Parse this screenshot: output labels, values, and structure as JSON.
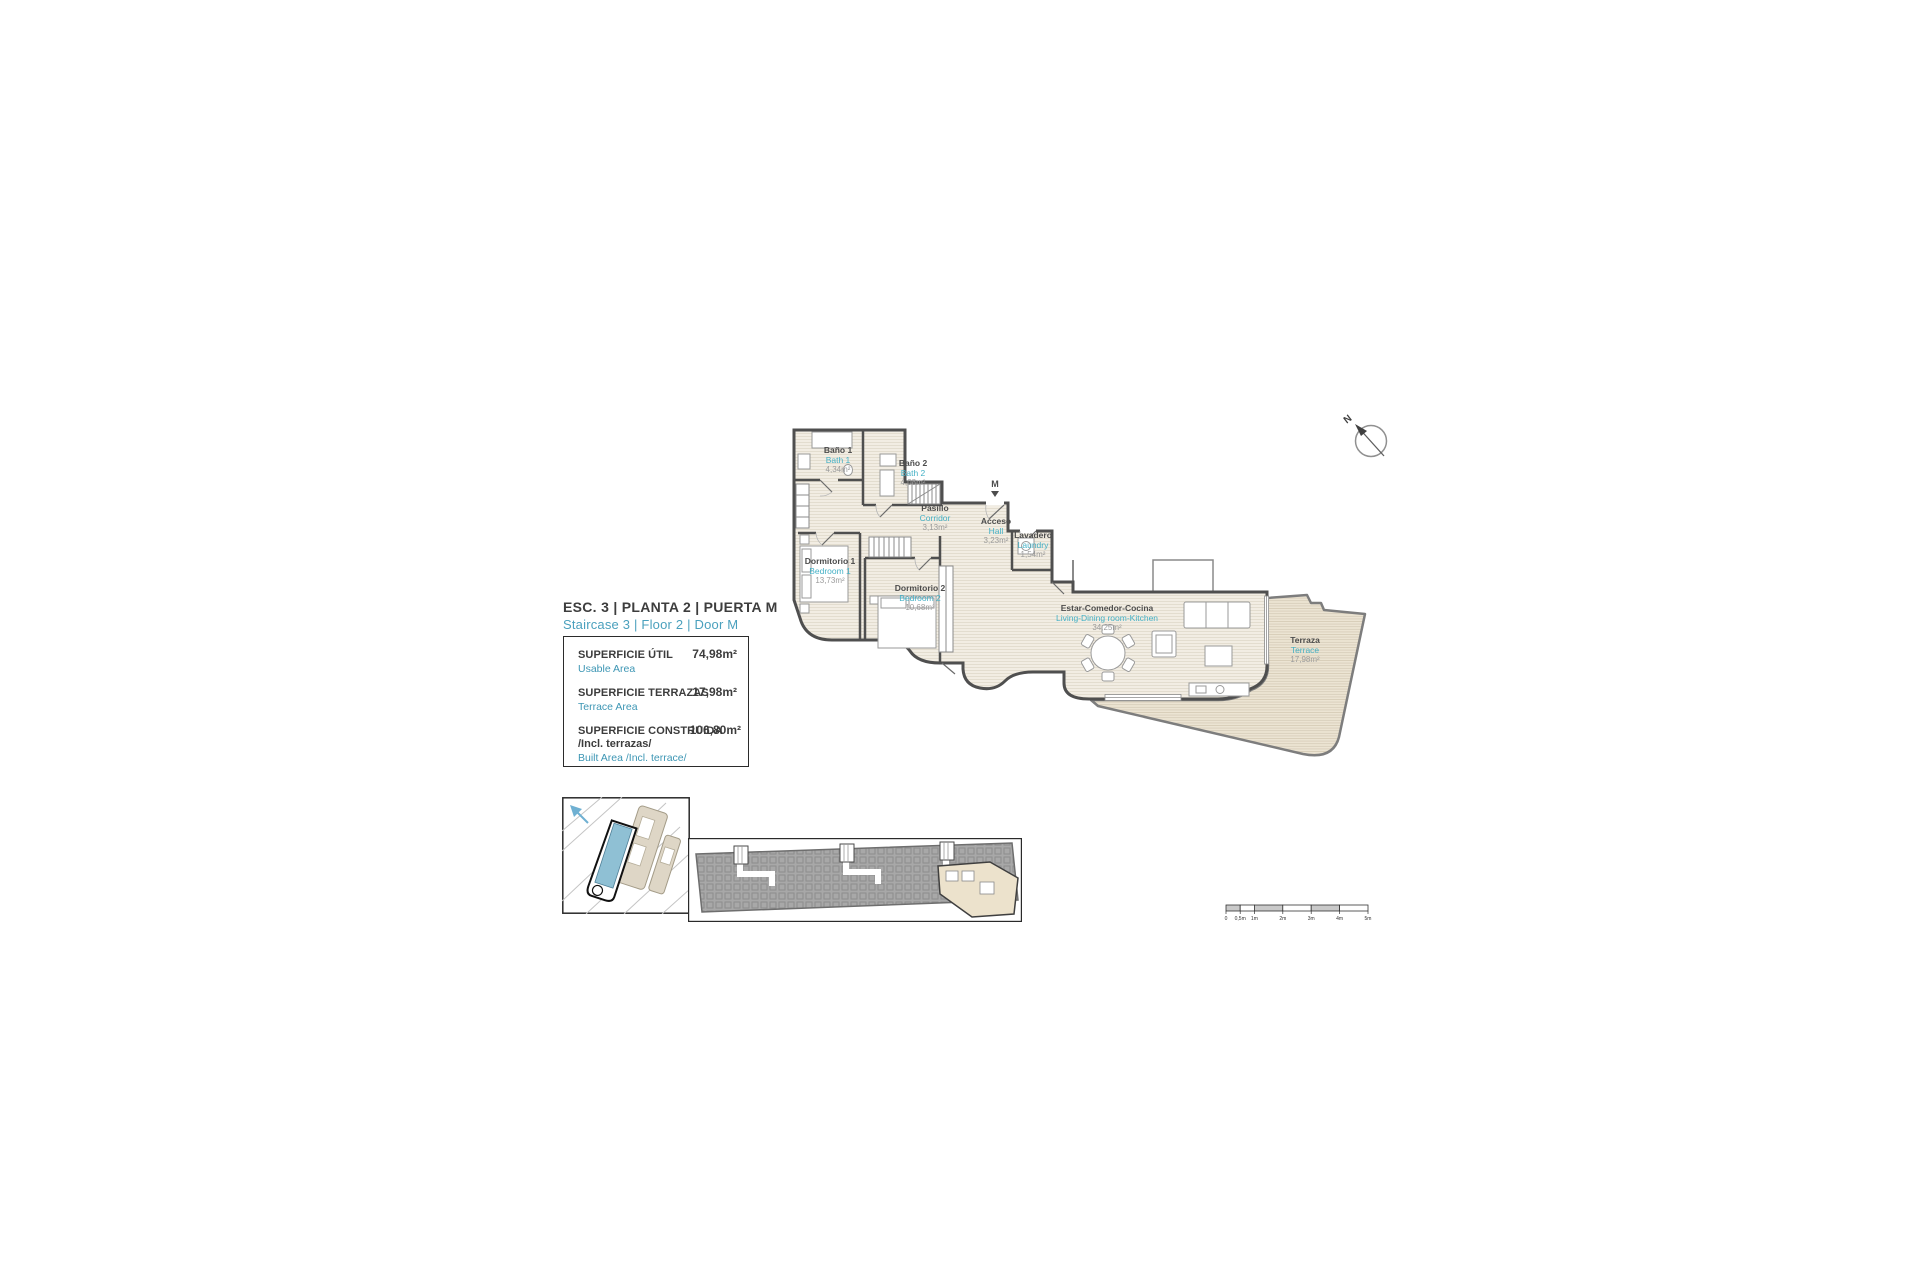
{
  "title": {
    "es": "ESC. 3 | PLANTA 2 | PUERTA M",
    "en": "Staircase 3 | Floor 2 | Door M"
  },
  "areas_box": {
    "usable": {
      "label_es": "SUPERFICIE ÚTIL",
      "label_en": "Usable Area",
      "value": "74,98m²"
    },
    "terrace": {
      "label_es": "SUPERFICIE TERRAZAS",
      "label_en": "Terrace Area",
      "value": "17,98m²"
    },
    "built": {
      "label_es": "SUPERFICIE CONSTRUIDA",
      "label_es2": "/Incl. terrazas/",
      "label_en": "Built Area /Incl. terrace/",
      "value": "106,80m²"
    }
  },
  "rooms": [
    {
      "name_es": "Baño 1",
      "name_en": "Bath 1",
      "area": "4,34m²"
    },
    {
      "name_es": "Baño 2",
      "name_en": "Bath 2",
      "area": "4,08m²"
    },
    {
      "name_es": "Pasillo",
      "name_en": "Corridor",
      "area": "3,13m²"
    },
    {
      "name_es": "Acceso",
      "name_en": "Hall",
      "area": "3,23m²"
    },
    {
      "name_es": "Lavadero",
      "name_en": "Laundry",
      "area": "1,54m²"
    },
    {
      "name_es": "Dormitorio 1",
      "name_en": "Bedroom 1",
      "area": "13,73m²"
    },
    {
      "name_es": "Dormitorio 2",
      "name_en": "Bedroom 2",
      "area": "10,68m²"
    },
    {
      "name_es": "Estar-Comedor-Cocina",
      "name_en": "Living-Dining room-Kitchen",
      "area": "34,25m²"
    },
    {
      "name_es": "Terraza",
      "name_en": "Terrace",
      "area": "17,98m²"
    }
  ],
  "plan": {
    "entrance_door": "M"
  },
  "north_label": "N",
  "scale_bar": {
    "labels": [
      "0",
      "0,5m",
      "1m",
      "2m",
      "3m",
      "4m",
      "5m"
    ]
  },
  "colors": {
    "accent_blue": "#4aa0bd",
    "room_cyan": "#45b1c6",
    "wall_gray": "#4f4f4f",
    "floor_beige": "#f2ede3",
    "terrace_beige": "#ece4d3",
    "site_highlight": "#8fc0d4"
  }
}
